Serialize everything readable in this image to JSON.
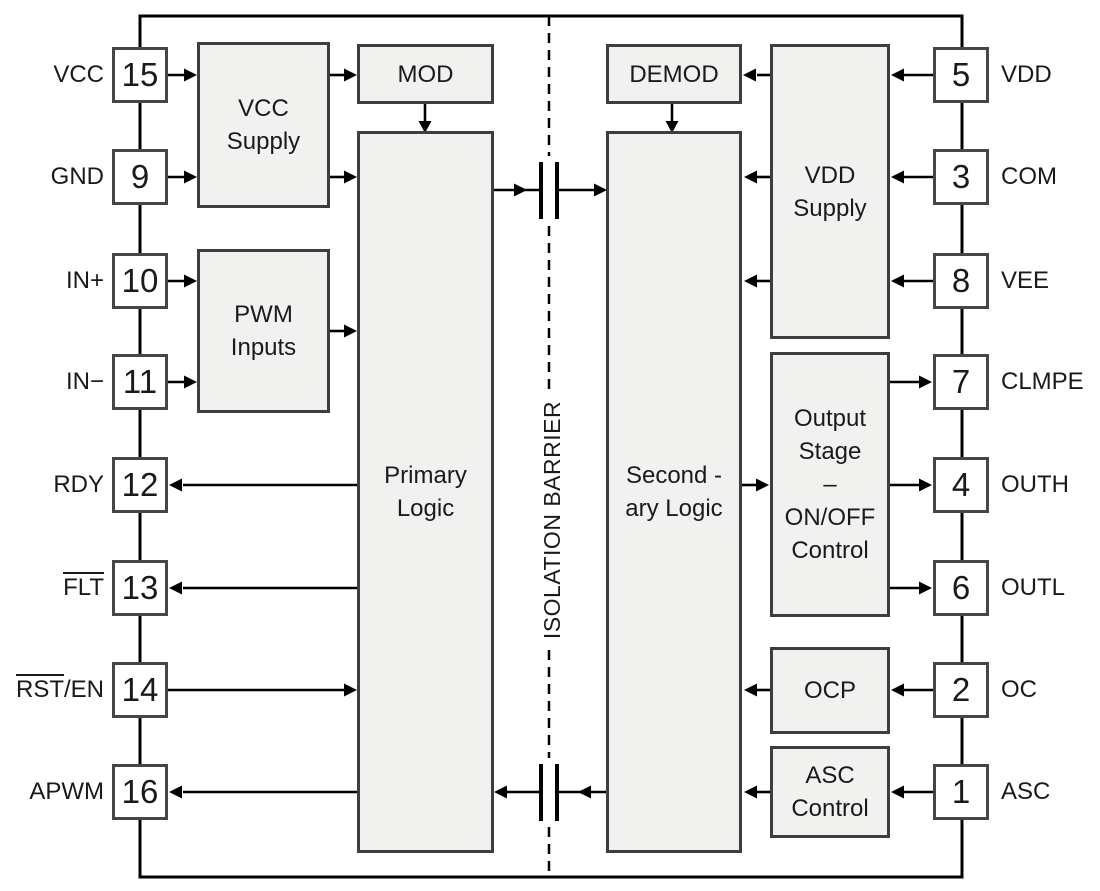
{
  "barrier_label": "ISOLATION BARRIER",
  "pins": {
    "left": [
      {
        "label": "VCC",
        "number": "15",
        "ov": "",
        "rest": "VCC"
      },
      {
        "label": "GND",
        "number": "9",
        "ov": "",
        "rest": "GND"
      },
      {
        "label": "IN+",
        "number": "10",
        "ov": "",
        "rest": "IN+"
      },
      {
        "label": "IN−",
        "number": "11",
        "ov": "",
        "rest": "IN−"
      },
      {
        "label": "RDY",
        "number": "12",
        "ov": "",
        "rest": "RDY"
      },
      {
        "label": "FLT",
        "number": "13",
        "ov": "FLT",
        "rest": ""
      },
      {
        "label": "RST/EN",
        "number": "14",
        "ov": "RST",
        "rest": "/EN"
      },
      {
        "label": "APWM",
        "number": "16",
        "ov": "",
        "rest": "APWM"
      }
    ],
    "right": [
      {
        "label": "VDD",
        "number": "5"
      },
      {
        "label": "COM",
        "number": "3"
      },
      {
        "label": "VEE",
        "number": "8"
      },
      {
        "label": "CLMPE",
        "number": "7"
      },
      {
        "label": "OUTH",
        "number": "4"
      },
      {
        "label": "OUTL",
        "number": "6"
      },
      {
        "label": "OC",
        "number": "2"
      },
      {
        "label": "ASC",
        "number": "1"
      }
    ]
  },
  "blocks": {
    "vcc_supply": {
      "lines": [
        "VCC",
        "Supply"
      ]
    },
    "pwm_inputs": {
      "lines": [
        "PWM",
        "Inputs"
      ]
    },
    "mod": {
      "lines": [
        "MOD"
      ]
    },
    "primary_logic": {
      "lines": [
        "Primary",
        "Logic"
      ]
    },
    "demod": {
      "lines": [
        "DEMOD"
      ]
    },
    "secondary_logic": {
      "lines": [
        "Second -",
        "ary Logic"
      ]
    },
    "vdd_supply": {
      "lines": [
        "VDD",
        "Supply"
      ]
    },
    "output_stage": {
      "lines": [
        "Output",
        "Stage",
        "–",
        "ON/OFF",
        "Control"
      ]
    },
    "ocp": {
      "lines": [
        "OCP"
      ]
    },
    "asc_control": {
      "lines": [
        "ASC",
        "Control"
      ]
    }
  },
  "colors": {
    "background": "#ffffff",
    "block_fill": "#f1f1ef",
    "block_border": "#3e3e3e",
    "wire": "#000000",
    "text": "#1a1a1a",
    "pin_fill": "#ffffff"
  }
}
